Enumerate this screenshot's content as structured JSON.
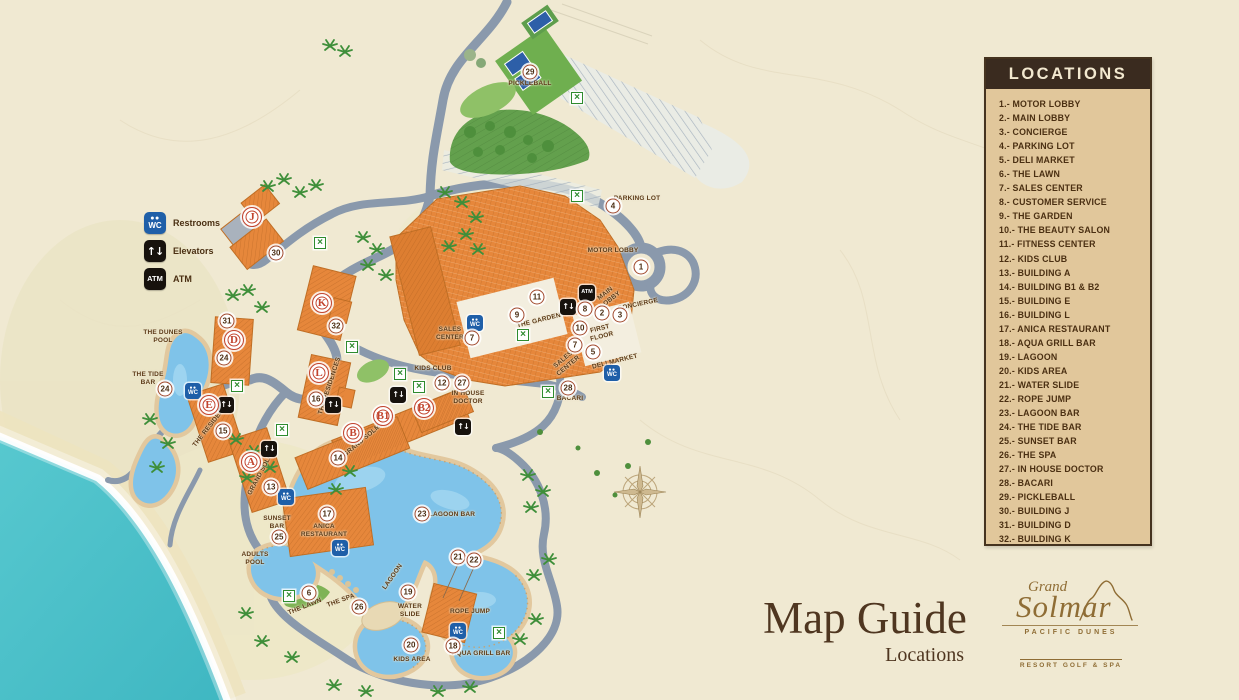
{
  "legend": {
    "title": "LOCATIONS",
    "items": [
      {
        "num": "1",
        "name": "MOTOR LOBBY"
      },
      {
        "num": "2",
        "name": "MAIN LOBBY"
      },
      {
        "num": "3",
        "name": "CONCIERGE"
      },
      {
        "num": "4",
        "name": "PARKING LOT"
      },
      {
        "num": "5",
        "name": "DELI MARKET"
      },
      {
        "num": "6",
        "name": "THE LAWN"
      },
      {
        "num": "7",
        "name": "SALES CENTER"
      },
      {
        "num": "8",
        "name": "CUSTOMER SERVICE"
      },
      {
        "num": "9",
        "name": "THE GARDEN"
      },
      {
        "num": "10",
        "name": "THE BEAUTY SALON"
      },
      {
        "num": "11",
        "name": "FITNESS CENTER"
      },
      {
        "num": "12",
        "name": "KIDS CLUB"
      },
      {
        "num": "13",
        "name": "BUILDING A"
      },
      {
        "num": "14",
        "name": "BUILDING B1 & B2"
      },
      {
        "num": "15",
        "name": "BUILDING E"
      },
      {
        "num": "16",
        "name": "BUILDING L"
      },
      {
        "num": "17",
        "name": "ANICA RESTAURANT"
      },
      {
        "num": "18",
        "name": "AQUA GRILL BAR"
      },
      {
        "num": "19",
        "name": "LAGOON"
      },
      {
        "num": "20",
        "name": "KIDS AREA"
      },
      {
        "num": "21",
        "name": "WATER SLIDE"
      },
      {
        "num": "22",
        "name": "ROPE JUMP"
      },
      {
        "num": "23",
        "name": "LAGOON BAR"
      },
      {
        "num": "24",
        "name": "THE TIDE BAR"
      },
      {
        "num": "25",
        "name": "SUNSET BAR"
      },
      {
        "num": "26",
        "name": "THE SPA"
      },
      {
        "num": "27",
        "name": "IN HOUSE DOCTOR"
      },
      {
        "num": "28",
        "name": "BACARI"
      },
      {
        "num": "29",
        "name": "PICKLEBALL"
      },
      {
        "num": "30",
        "name": "BUILDING J"
      },
      {
        "num": "31",
        "name": "BUILDING D"
      },
      {
        "num": "32",
        "name": "BUILDING K"
      }
    ]
  },
  "key": {
    "restrooms": "Restrooms",
    "elevators": "Elevators",
    "atm": "ATM"
  },
  "title": {
    "main": "Map Guide",
    "sub": "Locations"
  },
  "brand": {
    "script_top": "Grand",
    "script_main": "Solmar",
    "line1": "PACIFIC DUNES",
    "line2": "RESORT GOLF & SPA"
  },
  "colors": {
    "background": "#F0E9D2",
    "ocean": "#4AC1C9",
    "road": "#8A99AC",
    "building": "#E6873B",
    "water": "#7FC3E9",
    "green": "#7FB356",
    "legend_bg": "#E1C79B",
    "legend_header": "#3A2B1F",
    "text_brown": "#4A2F12",
    "marker_ring_red": "#C2452F",
    "crossing_green": "#2E8B2E",
    "restroom_blue": "#1F5FA8"
  },
  "map": {
    "numbers": [
      {
        "n": "1",
        "x": 641,
        "y": 267
      },
      {
        "n": "2",
        "x": 602,
        "y": 313
      },
      {
        "n": "3",
        "x": 620,
        "y": 315
      },
      {
        "n": "4",
        "x": 613,
        "y": 206
      },
      {
        "n": "5",
        "x": 593,
        "y": 352
      },
      {
        "n": "6",
        "x": 309,
        "y": 593
      },
      {
        "n": "7",
        "x": 575,
        "y": 345
      },
      {
        "n": "7",
        "x": 472,
        "y": 338
      },
      {
        "n": "8",
        "x": 585,
        "y": 309
      },
      {
        "n": "9",
        "x": 517,
        "y": 315
      },
      {
        "n": "10",
        "x": 580,
        "y": 328
      },
      {
        "n": "11",
        "x": 537,
        "y": 297
      },
      {
        "n": "12",
        "x": 442,
        "y": 383
      },
      {
        "n": "13",
        "x": 271,
        "y": 487
      },
      {
        "n": "14",
        "x": 338,
        "y": 458
      },
      {
        "n": "15",
        "x": 223,
        "y": 431
      },
      {
        "n": "16",
        "x": 316,
        "y": 399
      },
      {
        "n": "17",
        "x": 327,
        "y": 514
      },
      {
        "n": "18",
        "x": 453,
        "y": 646
      },
      {
        "n": "19",
        "x": 408,
        "y": 592
      },
      {
        "n": "20",
        "x": 411,
        "y": 645
      },
      {
        "n": "21",
        "x": 458,
        "y": 557
      },
      {
        "n": "22",
        "x": 474,
        "y": 560
      },
      {
        "n": "23",
        "x": 422,
        "y": 514
      },
      {
        "n": "24",
        "x": 165,
        "y": 389
      },
      {
        "n": "24",
        "x": 224,
        "y": 358
      },
      {
        "n": "25",
        "x": 279,
        "y": 537
      },
      {
        "n": "26",
        "x": 359,
        "y": 607
      },
      {
        "n": "27",
        "x": 462,
        "y": 383
      },
      {
        "n": "28",
        "x": 568,
        "y": 388
      },
      {
        "n": "29",
        "x": 530,
        "y": 72
      },
      {
        "n": "30",
        "x": 276,
        "y": 253
      },
      {
        "n": "31",
        "x": 227,
        "y": 321
      },
      {
        "n": "32",
        "x": 336,
        "y": 326
      }
    ],
    "letters": [
      {
        "l": "J",
        "x": 252,
        "y": 217
      },
      {
        "l": "K",
        "x": 322,
        "y": 303
      },
      {
        "l": "D",
        "x": 234,
        "y": 340
      },
      {
        "l": "L",
        "x": 319,
        "y": 373
      },
      {
        "l": "E",
        "x": 209,
        "y": 405
      },
      {
        "l": "A",
        "x": 251,
        "y": 462
      },
      {
        "l": "B",
        "x": 353,
        "y": 433
      },
      {
        "l": "B1",
        "x": 383,
        "y": 416
      },
      {
        "l": "B2",
        "x": 424,
        "y": 408
      }
    ],
    "crossings": [
      {
        "x": 577,
        "y": 98
      },
      {
        "x": 577,
        "y": 196
      },
      {
        "x": 523,
        "y": 335
      },
      {
        "x": 320,
        "y": 243
      },
      {
        "x": 352,
        "y": 347
      },
      {
        "x": 237,
        "y": 386
      },
      {
        "x": 282,
        "y": 430
      },
      {
        "x": 400,
        "y": 374
      },
      {
        "x": 419,
        "y": 387
      },
      {
        "x": 548,
        "y": 392
      },
      {
        "x": 289,
        "y": 596
      },
      {
        "x": 499,
        "y": 633
      }
    ],
    "badges": [
      {
        "t": "restroom",
        "x": 475,
        "y": 323
      },
      {
        "t": "restroom",
        "x": 612,
        "y": 373
      },
      {
        "t": "restroom",
        "x": 193,
        "y": 391
      },
      {
        "t": "restroom",
        "x": 340,
        "y": 548
      },
      {
        "t": "restroom",
        "x": 458,
        "y": 631
      },
      {
        "t": "restroom",
        "x": 286,
        "y": 497
      },
      {
        "t": "elevator",
        "x": 568,
        "y": 307
      },
      {
        "t": "elevator",
        "x": 226,
        "y": 405
      },
      {
        "t": "elevator",
        "x": 333,
        "y": 405
      },
      {
        "t": "elevator",
        "x": 398,
        "y": 395
      },
      {
        "t": "elevator",
        "x": 463,
        "y": 427
      },
      {
        "t": "elevator",
        "x": 269,
        "y": 449
      },
      {
        "t": "atm",
        "x": 587,
        "y": 293
      }
    ],
    "labels": [
      {
        "t": "PARKING LOT",
        "x": 637,
        "y": 199,
        "r": 0
      },
      {
        "t": "MOTOR LOBBY",
        "x": 613,
        "y": 251,
        "r": 0
      },
      {
        "t": "MAIN\nLOBBY",
        "x": 608,
        "y": 297,
        "r": -38
      },
      {
        "t": "CONCIERGE",
        "x": 638,
        "y": 305,
        "r": -12
      },
      {
        "t": "THE GARDEN",
        "x": 539,
        "y": 321,
        "r": -14
      },
      {
        "t": "FIRST\nFLOOR",
        "x": 601,
        "y": 333,
        "r": -14
      },
      {
        "t": "SALES\nCENTER",
        "x": 450,
        "y": 334,
        "r": 0
      },
      {
        "t": "SALES\nCENTER",
        "x": 566,
        "y": 363,
        "r": -40
      },
      {
        "t": "DELI MARKET",
        "x": 615,
        "y": 362,
        "r": -14
      },
      {
        "t": "BACARI",
        "x": 570,
        "y": 399,
        "r": 0
      },
      {
        "t": "KIDS CLUB",
        "x": 433,
        "y": 369,
        "r": 0
      },
      {
        "t": "IN HOUSE\nDOCTOR",
        "x": 468,
        "y": 398,
        "r": 0
      },
      {
        "t": "THE DUNES\nPOOL",
        "x": 163,
        "y": 337,
        "r": 0
      },
      {
        "t": "THE TIDE\nBAR",
        "x": 148,
        "y": 379,
        "r": 0
      },
      {
        "t": "THE RESIDENCES",
        "x": 213,
        "y": 423,
        "r": -52
      },
      {
        "t": "THE RESIDENCES",
        "x": 330,
        "y": 386,
        "r": -72
      },
      {
        "t": "GRAND SOLMAR",
        "x": 366,
        "y": 438,
        "r": -40
      },
      {
        "t": "GRAND SOLMAR",
        "x": 263,
        "y": 470,
        "r": -62
      },
      {
        "t": "ANICA\nRESTAURANT",
        "x": 324,
        "y": 531,
        "r": 0
      },
      {
        "t": "LAGOON BAR",
        "x": 452,
        "y": 515,
        "r": 0
      },
      {
        "t": "SUNSET\nBAR",
        "x": 277,
        "y": 523,
        "r": 0
      },
      {
        "t": "ADULTS\nPOOL",
        "x": 255,
        "y": 559,
        "r": 0
      },
      {
        "t": "THE LAWN",
        "x": 305,
        "y": 607,
        "r": -22
      },
      {
        "t": "THE SPA",
        "x": 341,
        "y": 601,
        "r": -20
      },
      {
        "t": "LAGOON",
        "x": 393,
        "y": 577,
        "r": -55
      },
      {
        "t": "WATER\nSLIDE",
        "x": 410,
        "y": 611,
        "r": 0
      },
      {
        "t": "ROPE JUMP",
        "x": 470,
        "y": 612,
        "r": 0
      },
      {
        "t": "KIDS AREA",
        "x": 412,
        "y": 660,
        "r": 0
      },
      {
        "t": "AQUA GRILL BAR",
        "x": 481,
        "y": 654,
        "r": 0
      },
      {
        "t": "PICKLEBALL",
        "x": 530,
        "y": 84,
        "r": 0
      }
    ]
  }
}
